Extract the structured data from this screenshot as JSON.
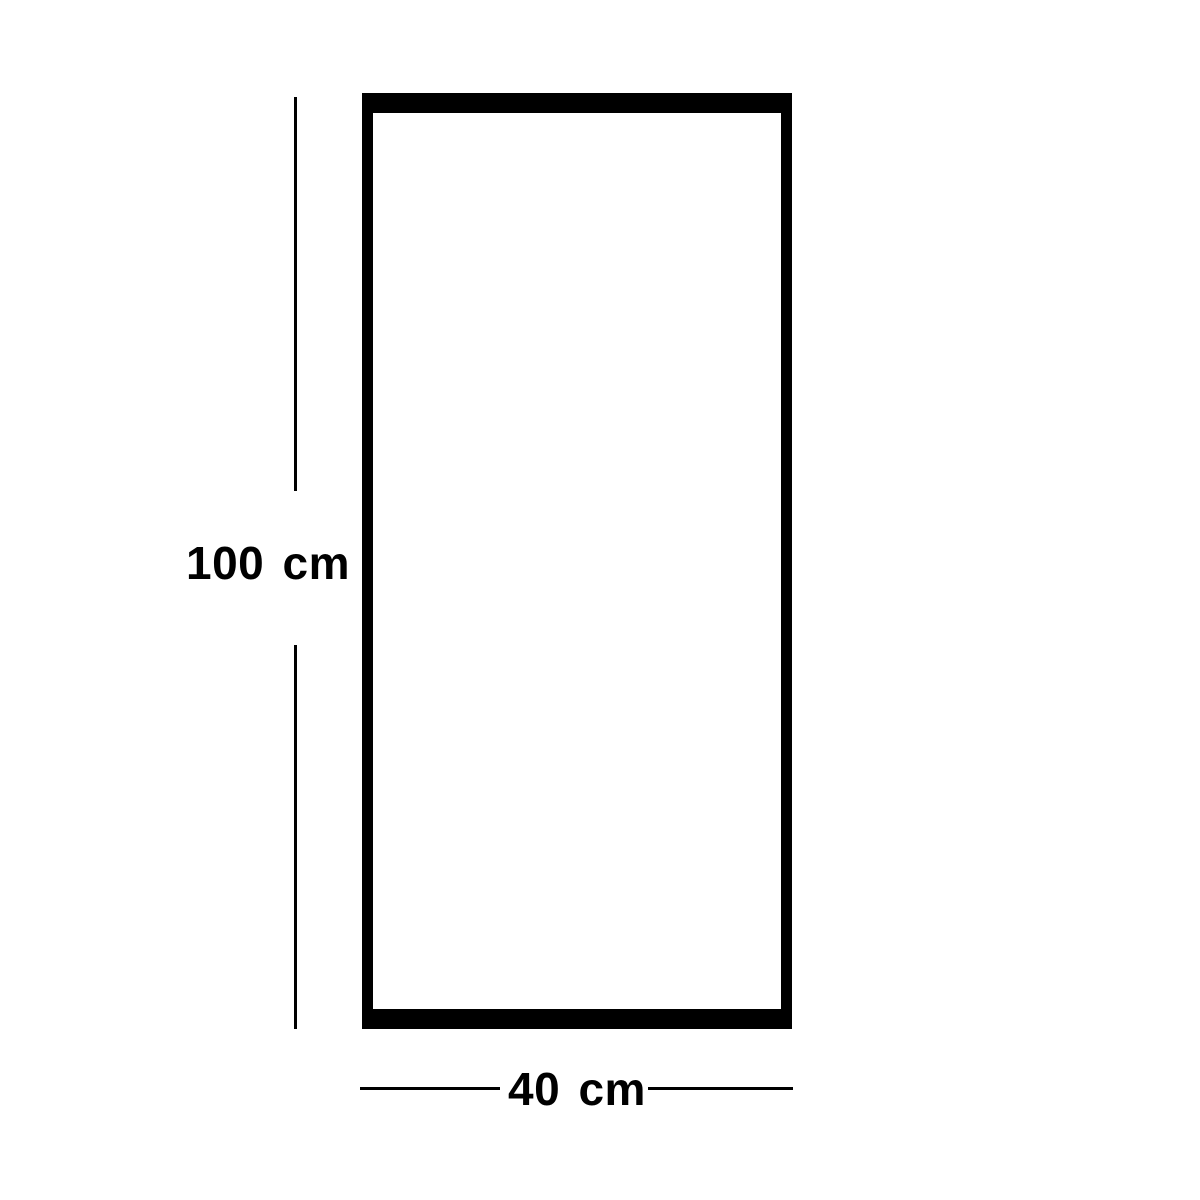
{
  "diagram": {
    "type": "product-dimension-diagram",
    "shape": "rectangle",
    "height_label": "100 cm",
    "width_label": "40 cm",
    "height_value_cm": 100,
    "width_value_cm": 40,
    "colors": {
      "line": "#000000",
      "background": "#ffffff"
    }
  }
}
